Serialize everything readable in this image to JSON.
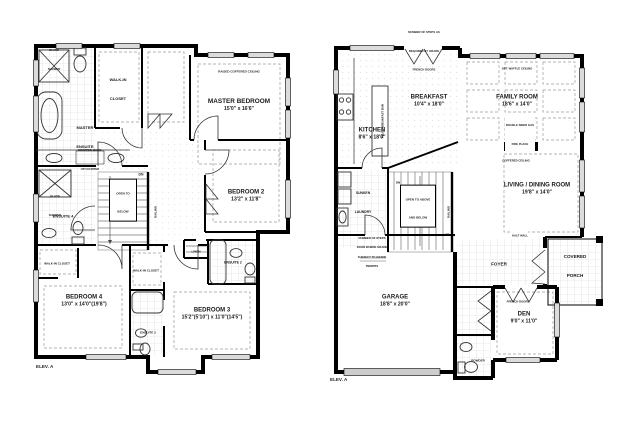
{
  "document": {
    "type": "architectural-floor-plan",
    "sheets": 2,
    "background": "#ffffff",
    "wall_color": "#000000",
    "window_color": "#d9d9d9"
  },
  "floors": {
    "second": {
      "elev": "ELEV. A",
      "master_bedroom": {
        "name": "MASTER BEDROOM",
        "dims": "15'0\" x 16'6\"",
        "ceiling": "RAISED COFFERED CEILING"
      },
      "bedroom2": {
        "name": "BEDROOM 2",
        "dims": "13'2\" x 11'8\""
      },
      "bedroom3": {
        "name": "BEDROOM 3",
        "dims": "15'2\"(5'10\") x 11'0\"(14'5\")"
      },
      "bedroom4": {
        "name": "BEDROOM 4",
        "dims": "13'0\" x 14'0\"(19'8\")"
      },
      "master_ensuite": "MASTER ENSUITE",
      "ensuite2": "ENSUITE 2",
      "ensuite3": "ENSUITE 3",
      "ensuite4": "ENSUITE 4",
      "walk_in_closet": "WALK-IN CLOSET",
      "glass_shower": "GLASS SHOWER",
      "makeup_counter": "DROPPED MAKE-UP COUNTER",
      "linen": "LINEN",
      "open_to_below": "OPEN TO BELOW",
      "dn": "DN",
      "railing": "RAILING"
    },
    "main": {
      "elev": "ELEV. A",
      "kitchen": {
        "name": "KITCHEN",
        "dims": "8'6\" x 18'0\""
      },
      "breakfast": {
        "name": "BREAKFAST",
        "dims": "10'4\" x 18'0\""
      },
      "family_room": {
        "name": "FAMILY ROOM",
        "dims": "18'6\" x 14'0\"",
        "ceiling": "OPT. WAFFLE CEILING"
      },
      "living_dining": {
        "name": "LIVING / DINING ROOM",
        "dims": "19'8\" x 14'0\"",
        "ceiling": "COFFERED CEILING"
      },
      "garage": {
        "name": "GARAGE",
        "dims": "18'8\" x 20'0\""
      },
      "den": {
        "name": "DEN",
        "dims": "9'0\" x 11'0\""
      },
      "foyer": "FOYER",
      "covered_porch": "COVERED PORCH",
      "powder": "POWDER",
      "sunken_laundry": "SUNKEN LAUNDRY",
      "open_to_above_and_below": "OPEN TO ABOVE AND BELOW",
      "flush_breakfast_bar": "FLUSH BREAKFAST BAR",
      "fireplace": "DOUBLE SIDED GAS FIRE PLACE",
      "half_wall": "HALF WALL",
      "french_doors": "FRENCH DOORS",
      "steps_note_top": "NUMBER OF STEPS AS REQUIRED BY GRADE",
      "steps_note_garage": "NUMBER OF STEPS SUBJECT TO GRADE",
      "door_grade_note": "DOOR WHERE GRADE PERMITS",
      "dn": "DN",
      "up": "UP",
      "railing": "RAILING"
    }
  }
}
